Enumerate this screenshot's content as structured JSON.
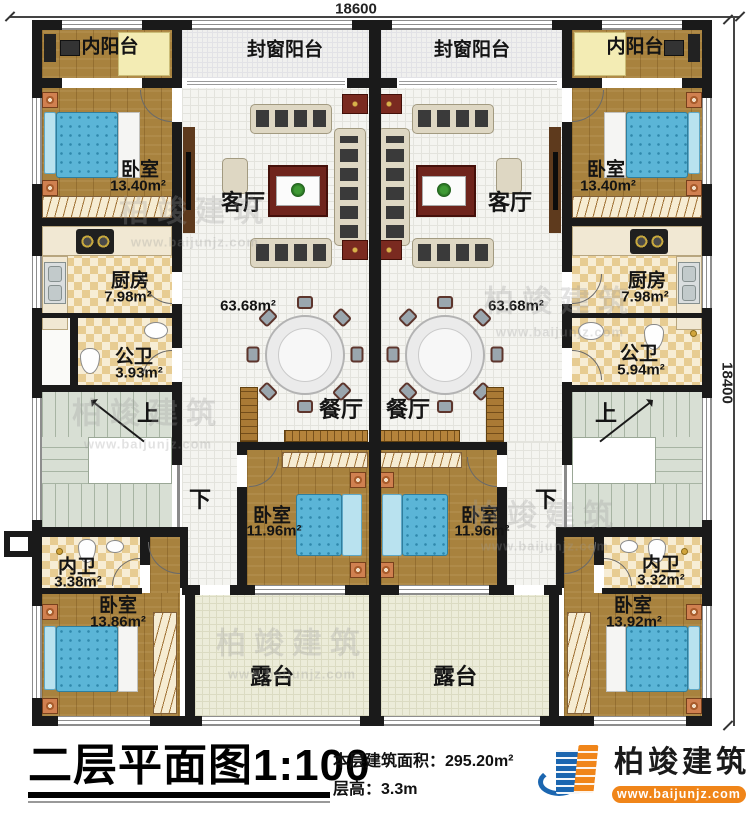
{
  "dims": {
    "top_width": "18600",
    "right_height": "18400"
  },
  "stairs": {
    "up": "上",
    "down": "下"
  },
  "left_unit": {
    "inner_balcony": "内阳台",
    "enclosed_balcony": "封窗阳台",
    "bedroom_top": {
      "name": "卧室",
      "area": "13.40m²"
    },
    "living": "客厅",
    "open_area": "63.68m²",
    "dining": "餐厅",
    "kitchen": {
      "name": "厨房",
      "area": "7.98m²"
    },
    "public_bath": {
      "name": "公卫",
      "area": "3.93m²"
    },
    "bedroom_mid": {
      "name": "卧室",
      "area": "11.96m²"
    },
    "inner_bath": {
      "name": "内卫",
      "area": "3.38m²"
    },
    "bedroom_bottom": {
      "name": "卧室",
      "area": "13.86m²"
    },
    "terrace": "露台"
  },
  "right_unit": {
    "inner_balcony": "内阳台",
    "enclosed_balcony": "封窗阳台",
    "bedroom_top": {
      "name": "卧室",
      "area": "13.40m²"
    },
    "living": "客厅",
    "open_area": "63.68m²",
    "dining": "餐厅",
    "kitchen": {
      "name": "厨房",
      "area": "7.98m²"
    },
    "public_bath": {
      "name": "公卫",
      "area": "5.94m²"
    },
    "bedroom_mid": {
      "name": "卧室",
      "area": "11.96m²"
    },
    "inner_bath": {
      "name": "内卫",
      "area": "3.32m²"
    },
    "bedroom_bottom": {
      "name": "卧室",
      "area": "13.92m²"
    },
    "terrace": "露台"
  },
  "title_block": {
    "title": "二层平面图1:100",
    "floor_area": "本层建筑面积：295.20m²",
    "floor_height": "层高：3.3m",
    "brand": "柏竣建筑",
    "website": "www.baijunjz.com"
  },
  "watermark": {
    "brand": "柏竣建筑",
    "website": "www.baijunjz.com"
  }
}
